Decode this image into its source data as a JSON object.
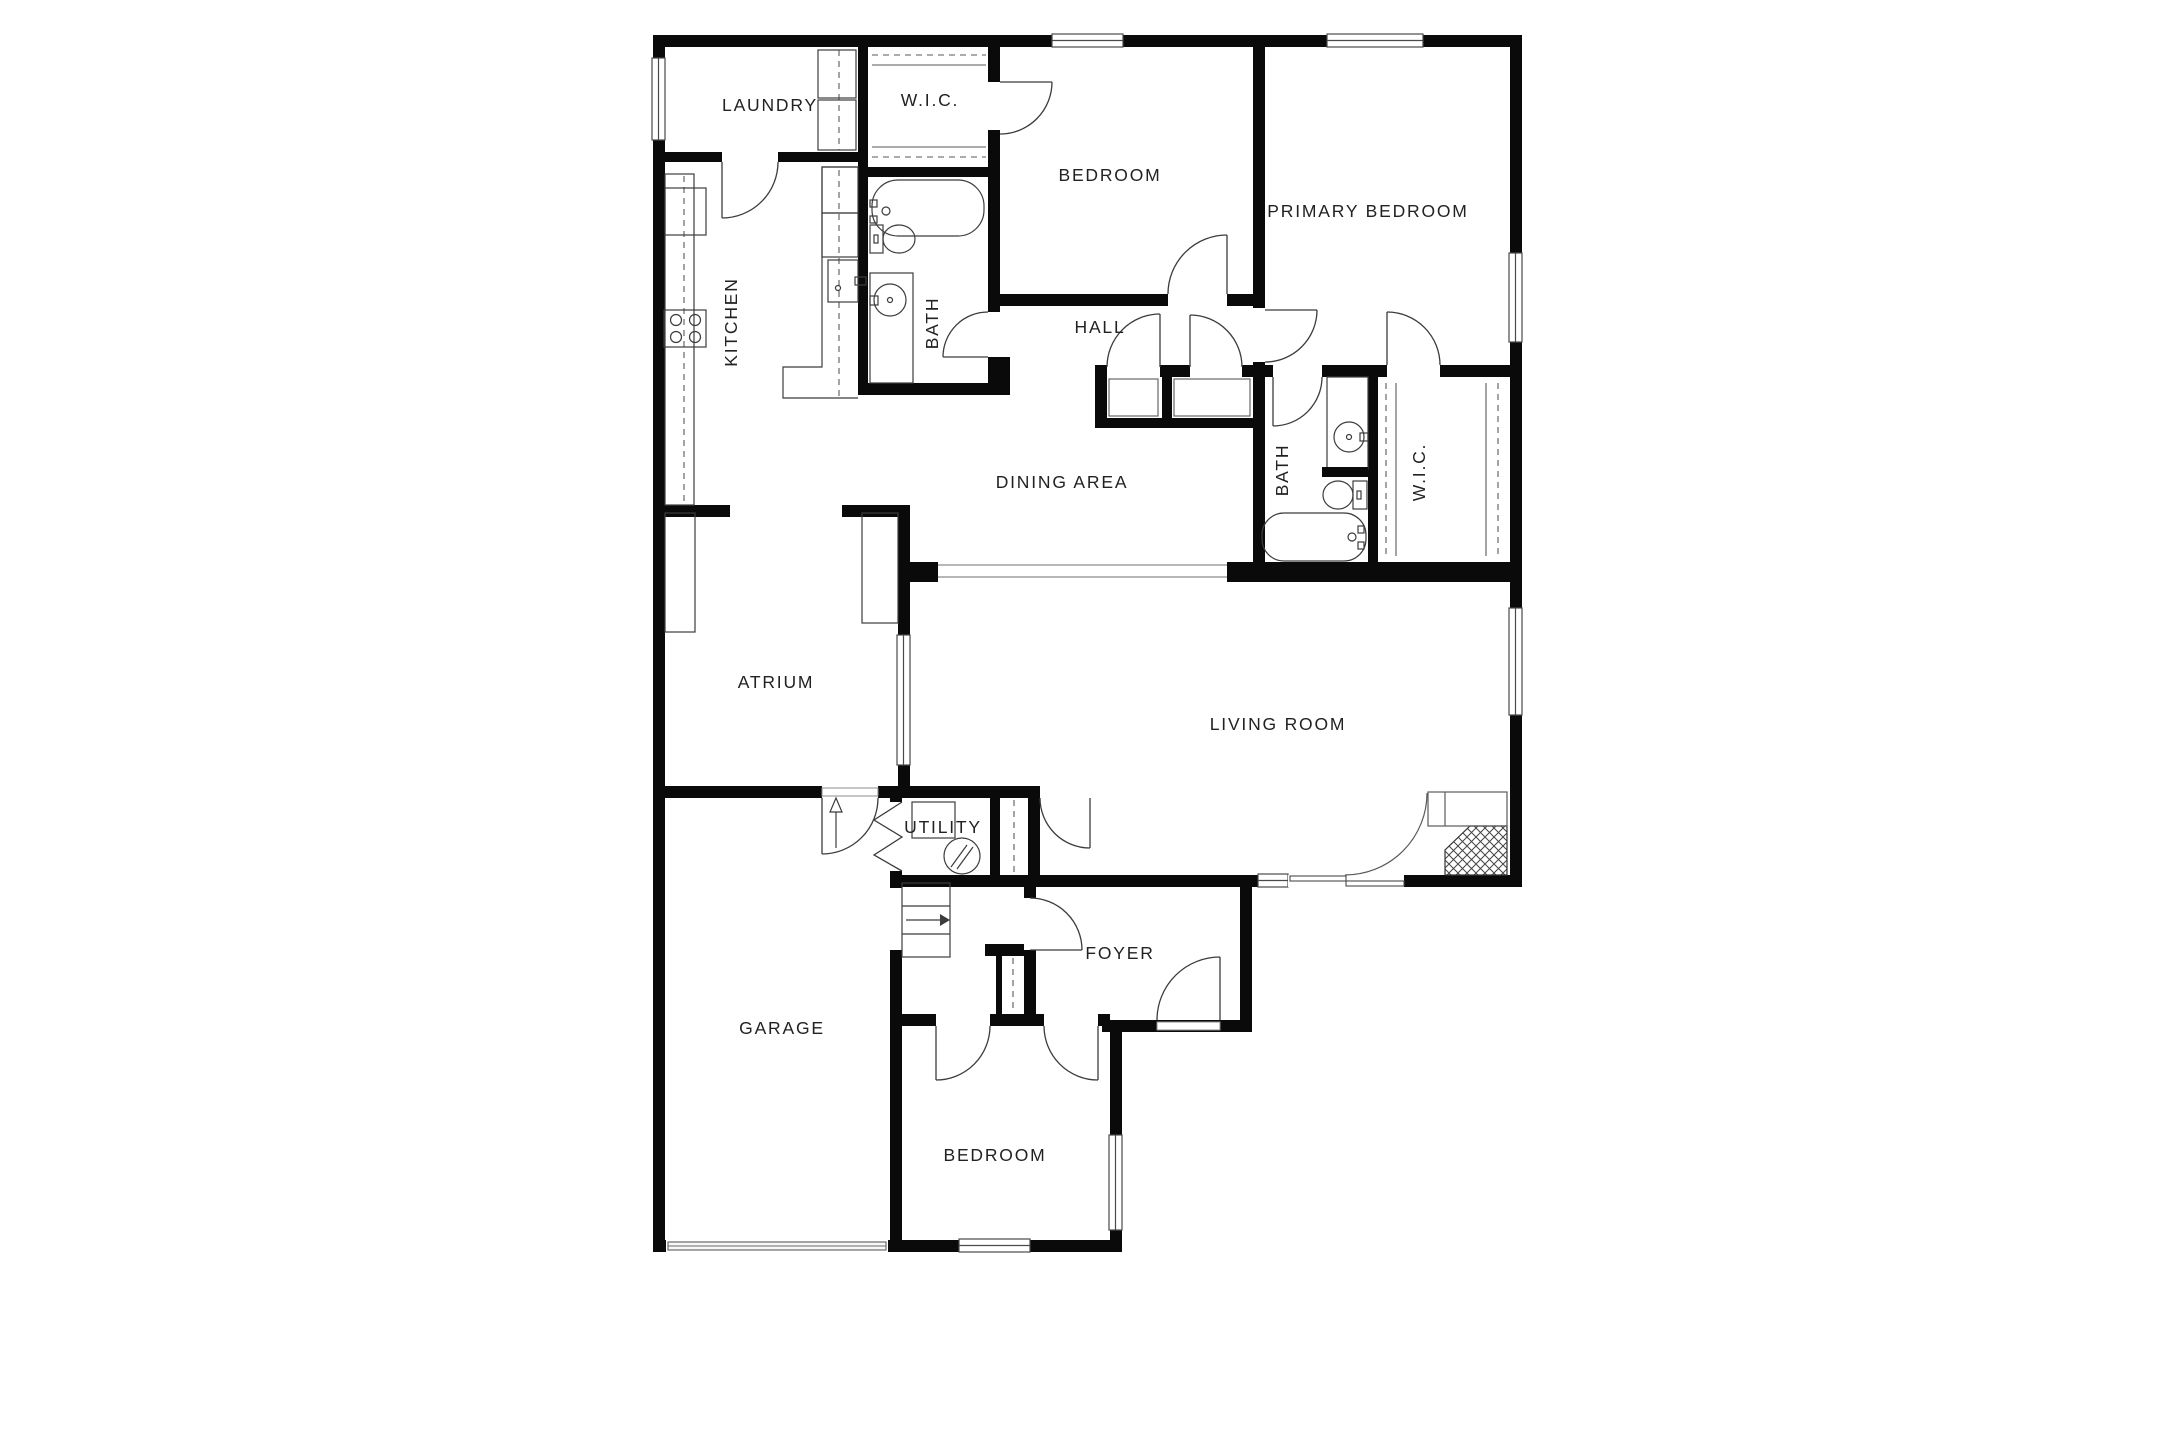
{
  "page": {
    "type": "floor-plan",
    "background_color": "#ffffff",
    "wall_color": "#0a0a0a",
    "outline_color": "#3c3c3c",
    "light_line_color": "#8c8c8c",
    "text_color": "#222222"
  },
  "floor_plan": {
    "rooms": [
      {
        "id": "laundry",
        "label": "LAUNDRY",
        "rotated": false
      },
      {
        "id": "wic-top",
        "label": "W.I.C.",
        "rotated": false
      },
      {
        "id": "bedroom-top",
        "label": "BEDROOM",
        "rotated": false
      },
      {
        "id": "primary-bedroom",
        "label": "PRIMARY BEDROOM",
        "rotated": false
      },
      {
        "id": "kitchen",
        "label": "KITCHEN",
        "rotated": true
      },
      {
        "id": "bath-top",
        "label": "BATH",
        "rotated": true
      },
      {
        "id": "hall",
        "label": "HALL",
        "rotated": false
      },
      {
        "id": "dining-area",
        "label": "DINING AREA",
        "rotated": false
      },
      {
        "id": "bath-right",
        "label": "BATH",
        "rotated": true
      },
      {
        "id": "wic-right",
        "label": "W.I.C.",
        "rotated": true
      },
      {
        "id": "atrium",
        "label": "ATRIUM",
        "rotated": false
      },
      {
        "id": "living-room",
        "label": "LIVING ROOM",
        "rotated": false
      },
      {
        "id": "utility",
        "label": "UTILITY",
        "rotated": false
      },
      {
        "id": "garage",
        "label": "GARAGE",
        "rotated": false
      },
      {
        "id": "foyer",
        "label": "FOYER",
        "rotated": false
      },
      {
        "id": "bedroom-bottom",
        "label": "BEDROOM",
        "rotated": false
      }
    ],
    "fixtures": [
      "bathtub",
      "toilet",
      "vanity-sink",
      "stove-cooktop",
      "refrigerator",
      "kitchen-sink",
      "washer-dryer-stack",
      "water-heater",
      "furnace-box",
      "fireplace",
      "stairs",
      "entry-arrow",
      "sliding-glass-door",
      "garage-door",
      "closet-rod-dashed",
      "bifold-closet-door",
      "accordion-door",
      "hinged-door-swing",
      "window"
    ]
  }
}
